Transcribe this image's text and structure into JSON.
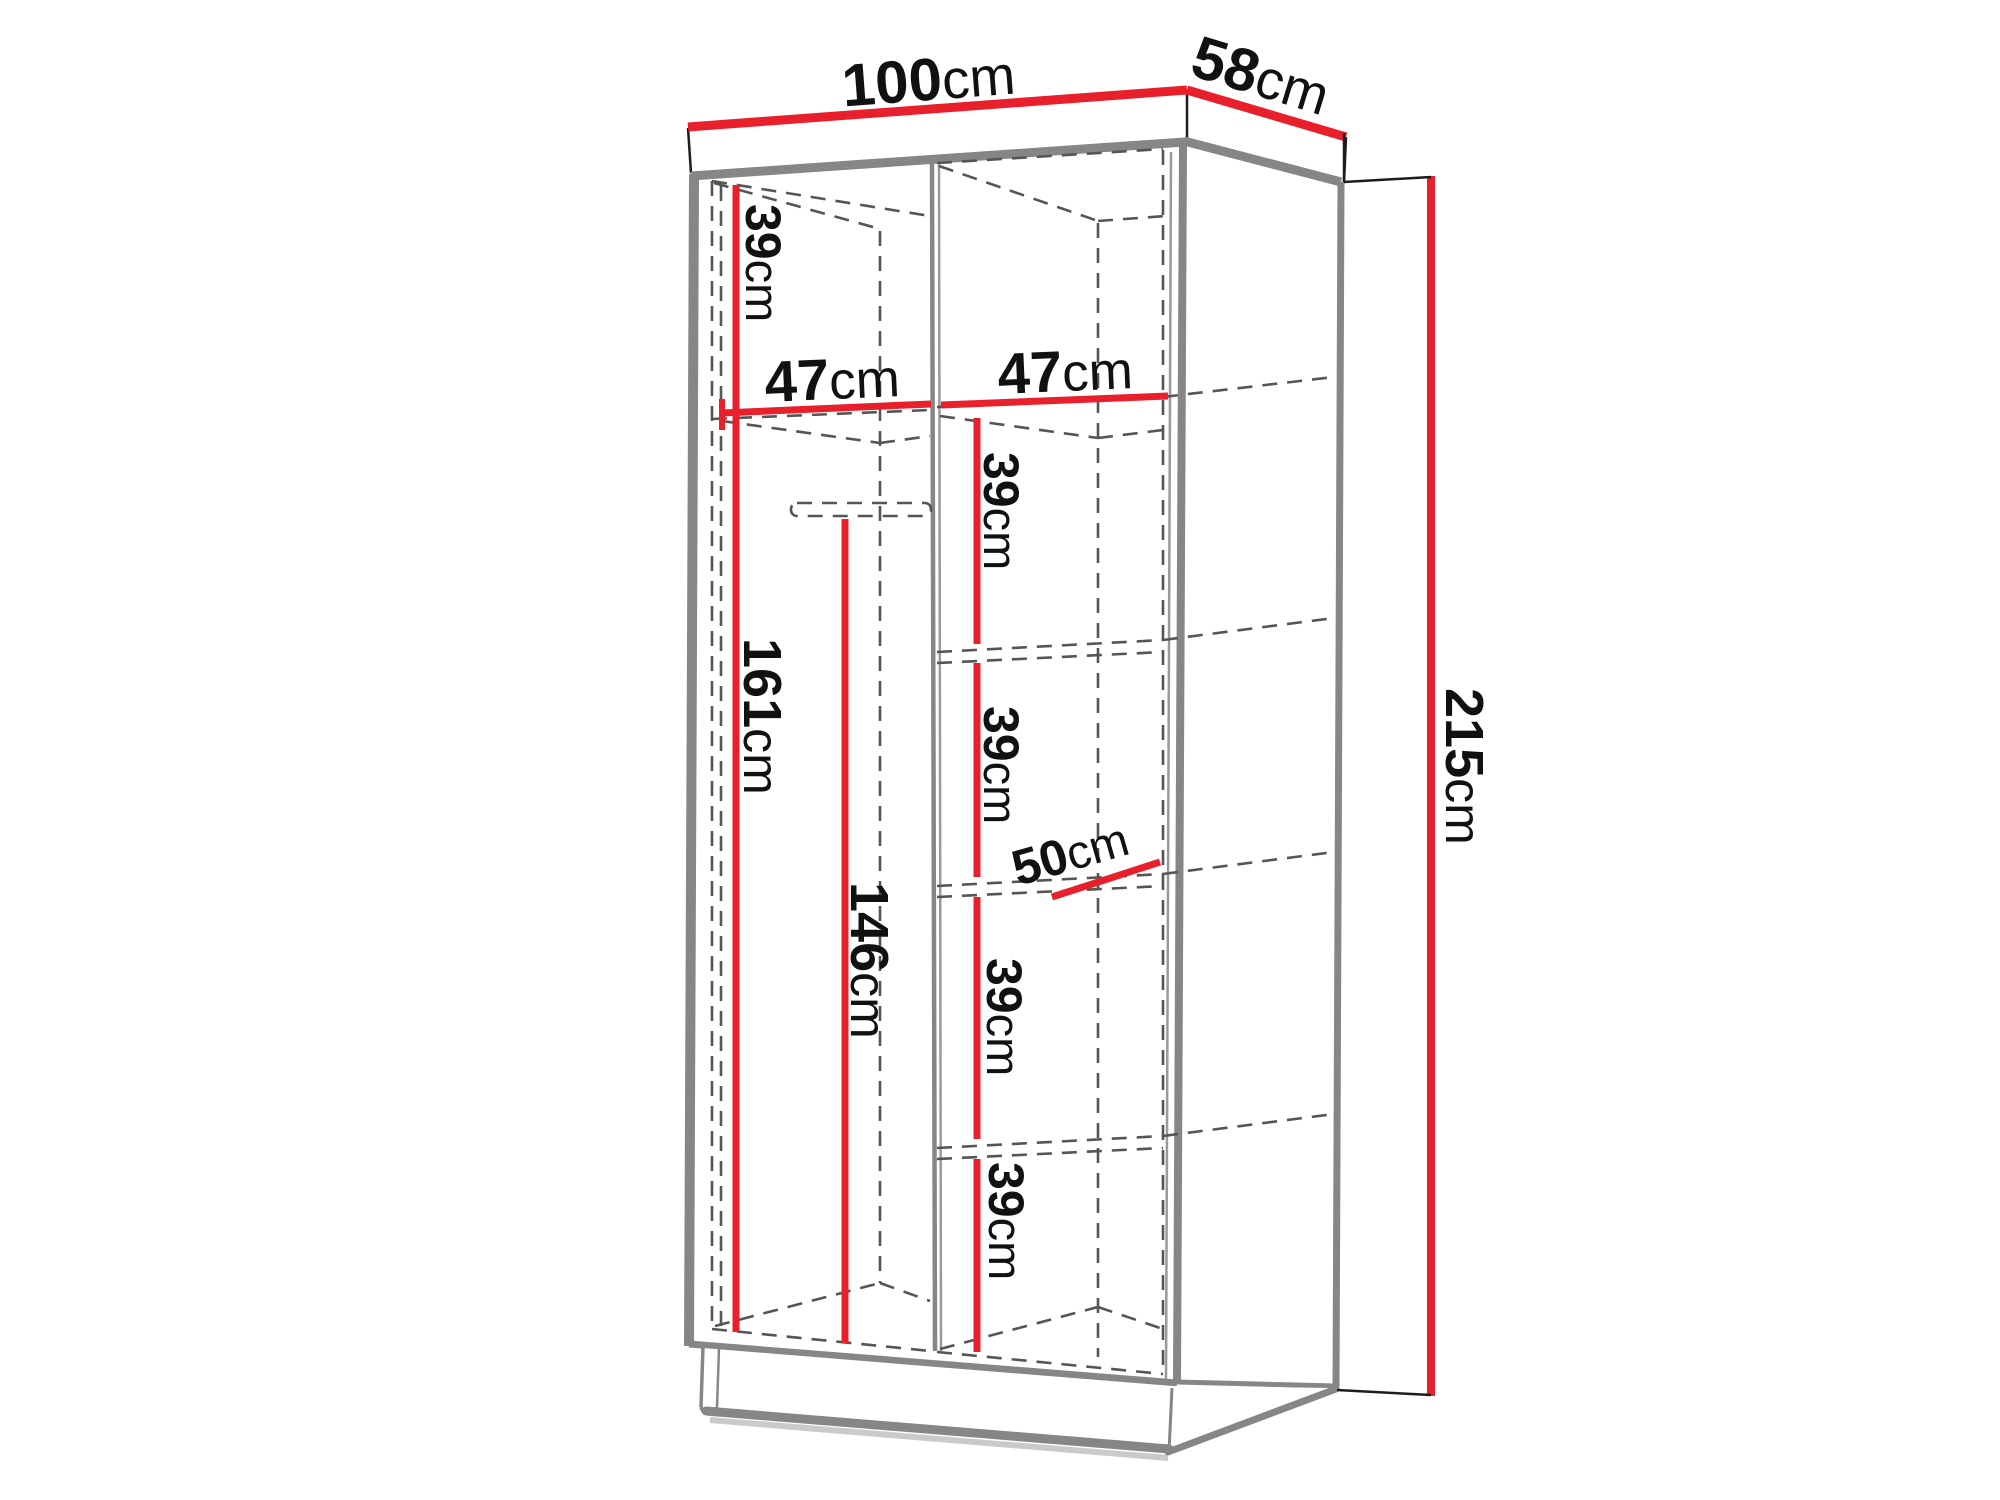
{
  "meta": {
    "description": "Technical line drawing of a two-door wardrobe shown in perspective with red measurement lines",
    "unit": "cm"
  },
  "colors": {
    "dimension_red": "#e8202c",
    "frame_gray": "#868686",
    "hidden_edge_gray": "#555555",
    "text_black": "#111111",
    "background": "#ffffff"
  },
  "dimensions": {
    "width": {
      "value": "100",
      "unit": "cm"
    },
    "depth": {
      "value": "58",
      "unit": "cm"
    },
    "height": {
      "value": "215",
      "unit": "cm"
    },
    "top_shelf_drop": {
      "value": "39",
      "unit": "cm"
    },
    "left_section_width": {
      "value": "47",
      "unit": "cm"
    },
    "right_section_width": {
      "value": "47",
      "unit": "cm"
    },
    "hanging_section_height": {
      "value": "161",
      "unit": "cm"
    },
    "rail_clearance_height": {
      "value": "146",
      "unit": "cm"
    },
    "shelf_depth": {
      "value": "50",
      "unit": "cm"
    },
    "right_shelf_gaps": [
      {
        "value": "39",
        "unit": "cm"
      },
      {
        "value": "39",
        "unit": "cm"
      },
      {
        "value": "39",
        "unit": "cm"
      },
      {
        "value": "39",
        "unit": "cm"
      }
    ]
  }
}
